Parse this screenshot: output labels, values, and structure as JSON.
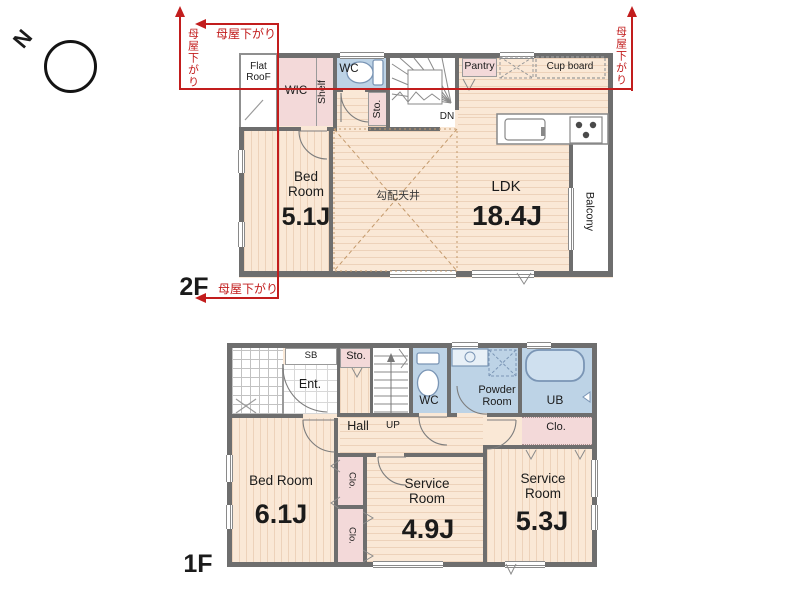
{
  "compass": {
    "north": "N"
  },
  "notes": {
    "roof_lowered": "母屋下がり",
    "sloped_ceiling": "勾配天井"
  },
  "floor2": {
    "label": "2F",
    "flat_roof": "Flat RooF",
    "wic": "WIC",
    "shelf": "Shelf",
    "wc": "WC",
    "sto": "Sto.",
    "dn": "DN",
    "pantry": "Pantry",
    "cup_board": "Cup board",
    "bedroom": {
      "name": "Bed Room",
      "size": "5.1J"
    },
    "ldk": {
      "name": "LDK",
      "size": "18.4J"
    },
    "balcony": "Balcony"
  },
  "floor1": {
    "label": "1F",
    "sb": "SB",
    "ent": "Ent.",
    "sto": "Sto.",
    "up": "UP",
    "hall": "Hall",
    "wc": "WC",
    "powder": "Powder Room",
    "ub": "UB",
    "clo": "Clo.",
    "bedroom": {
      "name": "Bed Room",
      "size": "6.1J"
    },
    "service": "Service Room",
    "service1_size": "4.9J",
    "service2_size": "5.3J"
  }
}
